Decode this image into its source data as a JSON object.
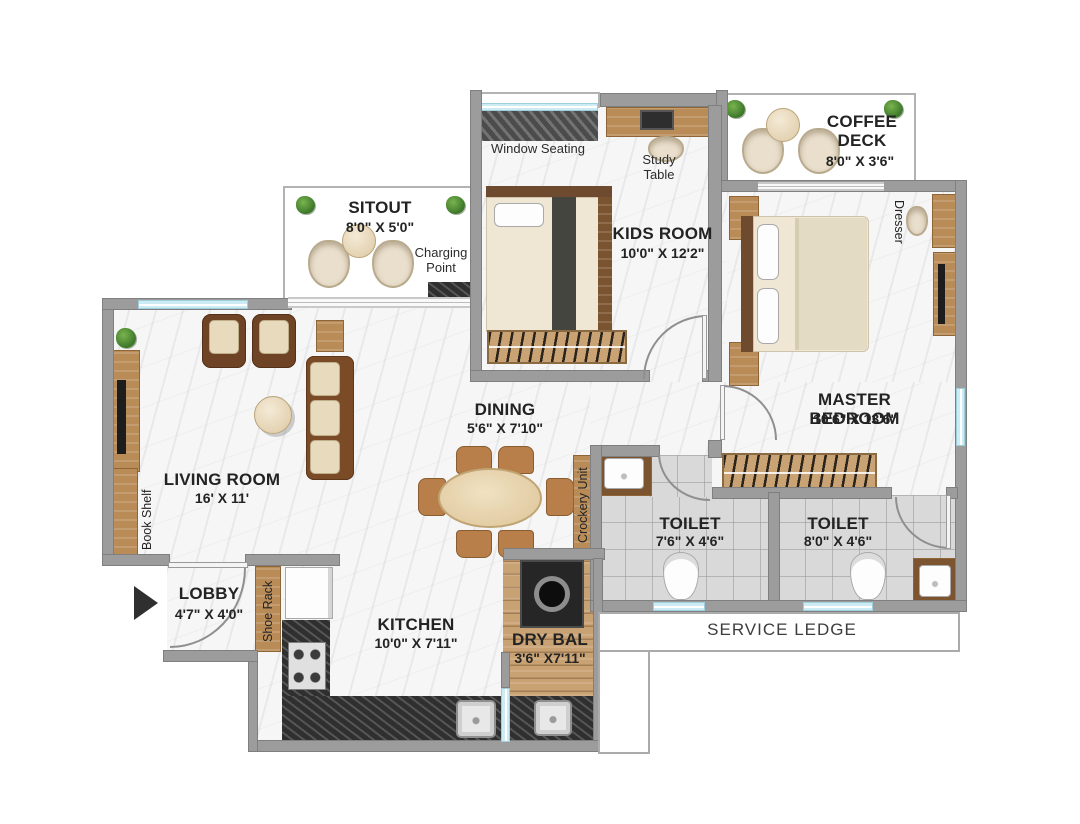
{
  "rooms": {
    "sitout": {
      "name": "SITOUT",
      "dims": "8'0\" X 5'0\""
    },
    "kids_room": {
      "name": "KIDS ROOM",
      "dims": "10'0\" X 12'2\""
    },
    "coffee_deck": {
      "name": "COFFEE DECK",
      "dims": "8'0\" X 3'6\""
    },
    "master_bedroom": {
      "name": "MASTER BEDROOM",
      "dims": "10'6\" X 13'6\""
    },
    "living_room": {
      "name": "LIVING ROOM",
      "dims": "16' X 11'"
    },
    "dining": {
      "name": "DINING",
      "dims": "5'6\" X 7'10\""
    },
    "toilet_1": {
      "name": "TOILET",
      "dims": "7'6\" X 4'6\""
    },
    "toilet_2": {
      "name": "TOILET",
      "dims": "8'0\" X 4'6\""
    },
    "lobby": {
      "name": "LOBBY",
      "dims": "4'7\" X 4'0\""
    },
    "kitchen": {
      "name": "KITCHEN",
      "dims": "10'0\" X 7'11\""
    },
    "dry_balcony": {
      "name": "DRY BAL",
      "dims": "3'6\" X7'11\""
    }
  },
  "annotations": {
    "window_seating": "Window Seating",
    "study_table": "Study Table",
    "charging_point": "Charging Point",
    "dresser": "Dresser",
    "book_shelf": "Book Shelf",
    "shoe_rack": "Shoe Rack",
    "crockery_unit": "Crockery Unit",
    "service_ledge": "SERVICE LEDGE"
  },
  "colors": {
    "wall": "#9c9c9c",
    "wood_deck": "#cda77a",
    "granite_counter": "#3e3e3e",
    "toilet_tile": "#d9d9d9",
    "window_glass": "#cdebf3",
    "plant_green": "#4f8f35",
    "label_text": "#232323"
  }
}
